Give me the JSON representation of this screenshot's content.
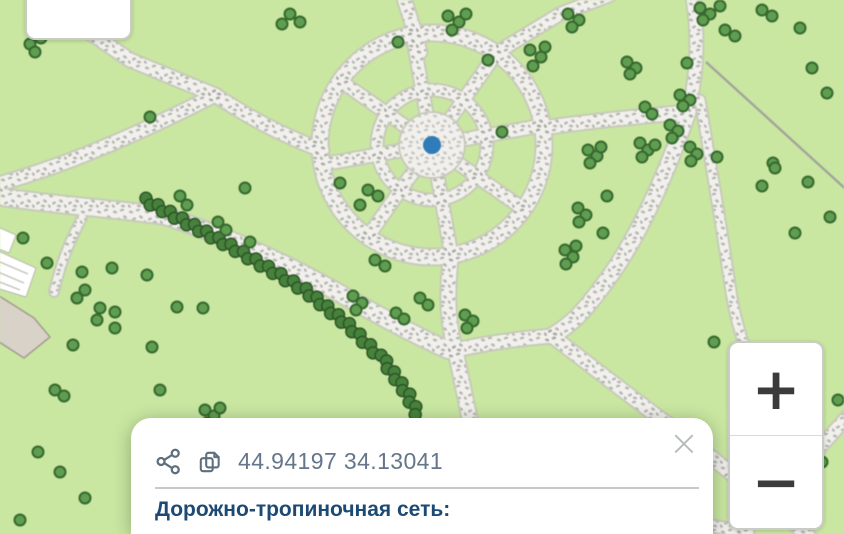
{
  "map": {
    "description": "park footpath network with radial wheel plaza and fountain",
    "colors": {
      "park_green": "#c9e7a1",
      "path_fill": "#f1f0ec",
      "path_casing": "#c6c8ba",
      "stipple": "#a9a9a6",
      "tree_fill": "#5f9e51",
      "tree_stroke": "#36682e",
      "hedge_fill": "#47823c",
      "hedge_stroke": "#2c5527",
      "building_fill": "#d8d2c8",
      "building_stroke": "#a29c90",
      "fountain_blue": "#2f7cb8",
      "fence_gray": "#a3a49c"
    },
    "features": [
      "radial-path-wheel",
      "fountain",
      "tree-clusters",
      "hedge-row",
      "building",
      "stairs"
    ]
  },
  "popup": {
    "coordinates": "44.94197 34.13041",
    "title": "Дорожно-тропиночная сеть:",
    "close_label": "×",
    "share_icon": "share-icon",
    "copy_icon": "copy-icon"
  },
  "zoom_control": {
    "zoom_in_label": "+",
    "zoom_out_label": "−"
  }
}
